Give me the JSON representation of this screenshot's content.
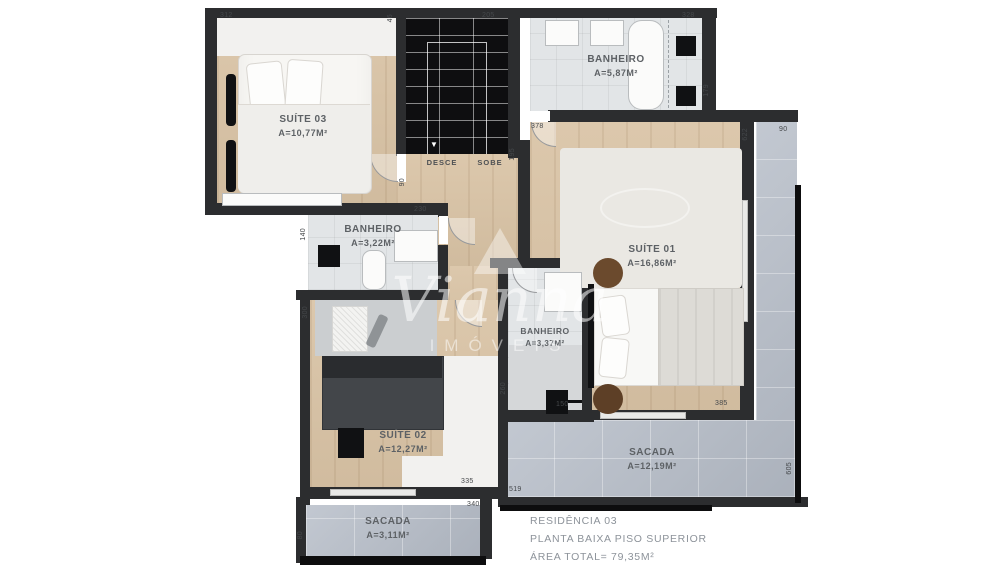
{
  "plan": {
    "watermark": {
      "brand": "Vianna",
      "subtitle": "IMÓVEIS"
    },
    "info": {
      "line1": "RESIDÊNCIA 03",
      "line2": "PLANTA BAIXA PISO SUPERIOR",
      "line3": "ÁREA TOTAL= 79,35M²"
    },
    "rooms": {
      "suite03": {
        "name": "SUÍTE 03",
        "area": "A=10,77M²"
      },
      "banheiro_top": {
        "name": "BANHEIRO",
        "area": "A=5,87M²"
      },
      "suite01": {
        "name": "SUÍTE 01",
        "area": "A=16,86M²"
      },
      "banheiro_mid": {
        "name": "BANHEIRO",
        "area": "A=3,22M²"
      },
      "banheiro_center": {
        "name": "BANHEIRO",
        "area": "A=3,37M²"
      },
      "suite02": {
        "name": "SUÍTE 02",
        "area": "A=12,27M²"
      },
      "sacada_big": {
        "name": "SACADA",
        "area": "A=12,19M²"
      },
      "sacada_small": {
        "name": "SACADA",
        "area": "A=3,11M²"
      }
    },
    "stairs": {
      "down": "DESCE",
      "up": "SOBE"
    },
    "icons": {
      "stairs_down_arrow": "▼"
    },
    "dimensions": [
      "312",
      "46",
      "205",
      "328",
      "179",
      "90",
      "622",
      "378",
      "195",
      "90",
      "230",
      "140",
      "300",
      "260",
      "150",
      "385",
      "335",
      "519",
      "340",
      "80",
      "605"
    ],
    "colors": {
      "wall": "#2c2d2f",
      "wood_floor": "#d9c3a5",
      "bath_floor": "#e2e5e7",
      "tile_floor": "#b5bcc7",
      "label_text": "#5d6165",
      "info_text": "#8d939a"
    }
  }
}
